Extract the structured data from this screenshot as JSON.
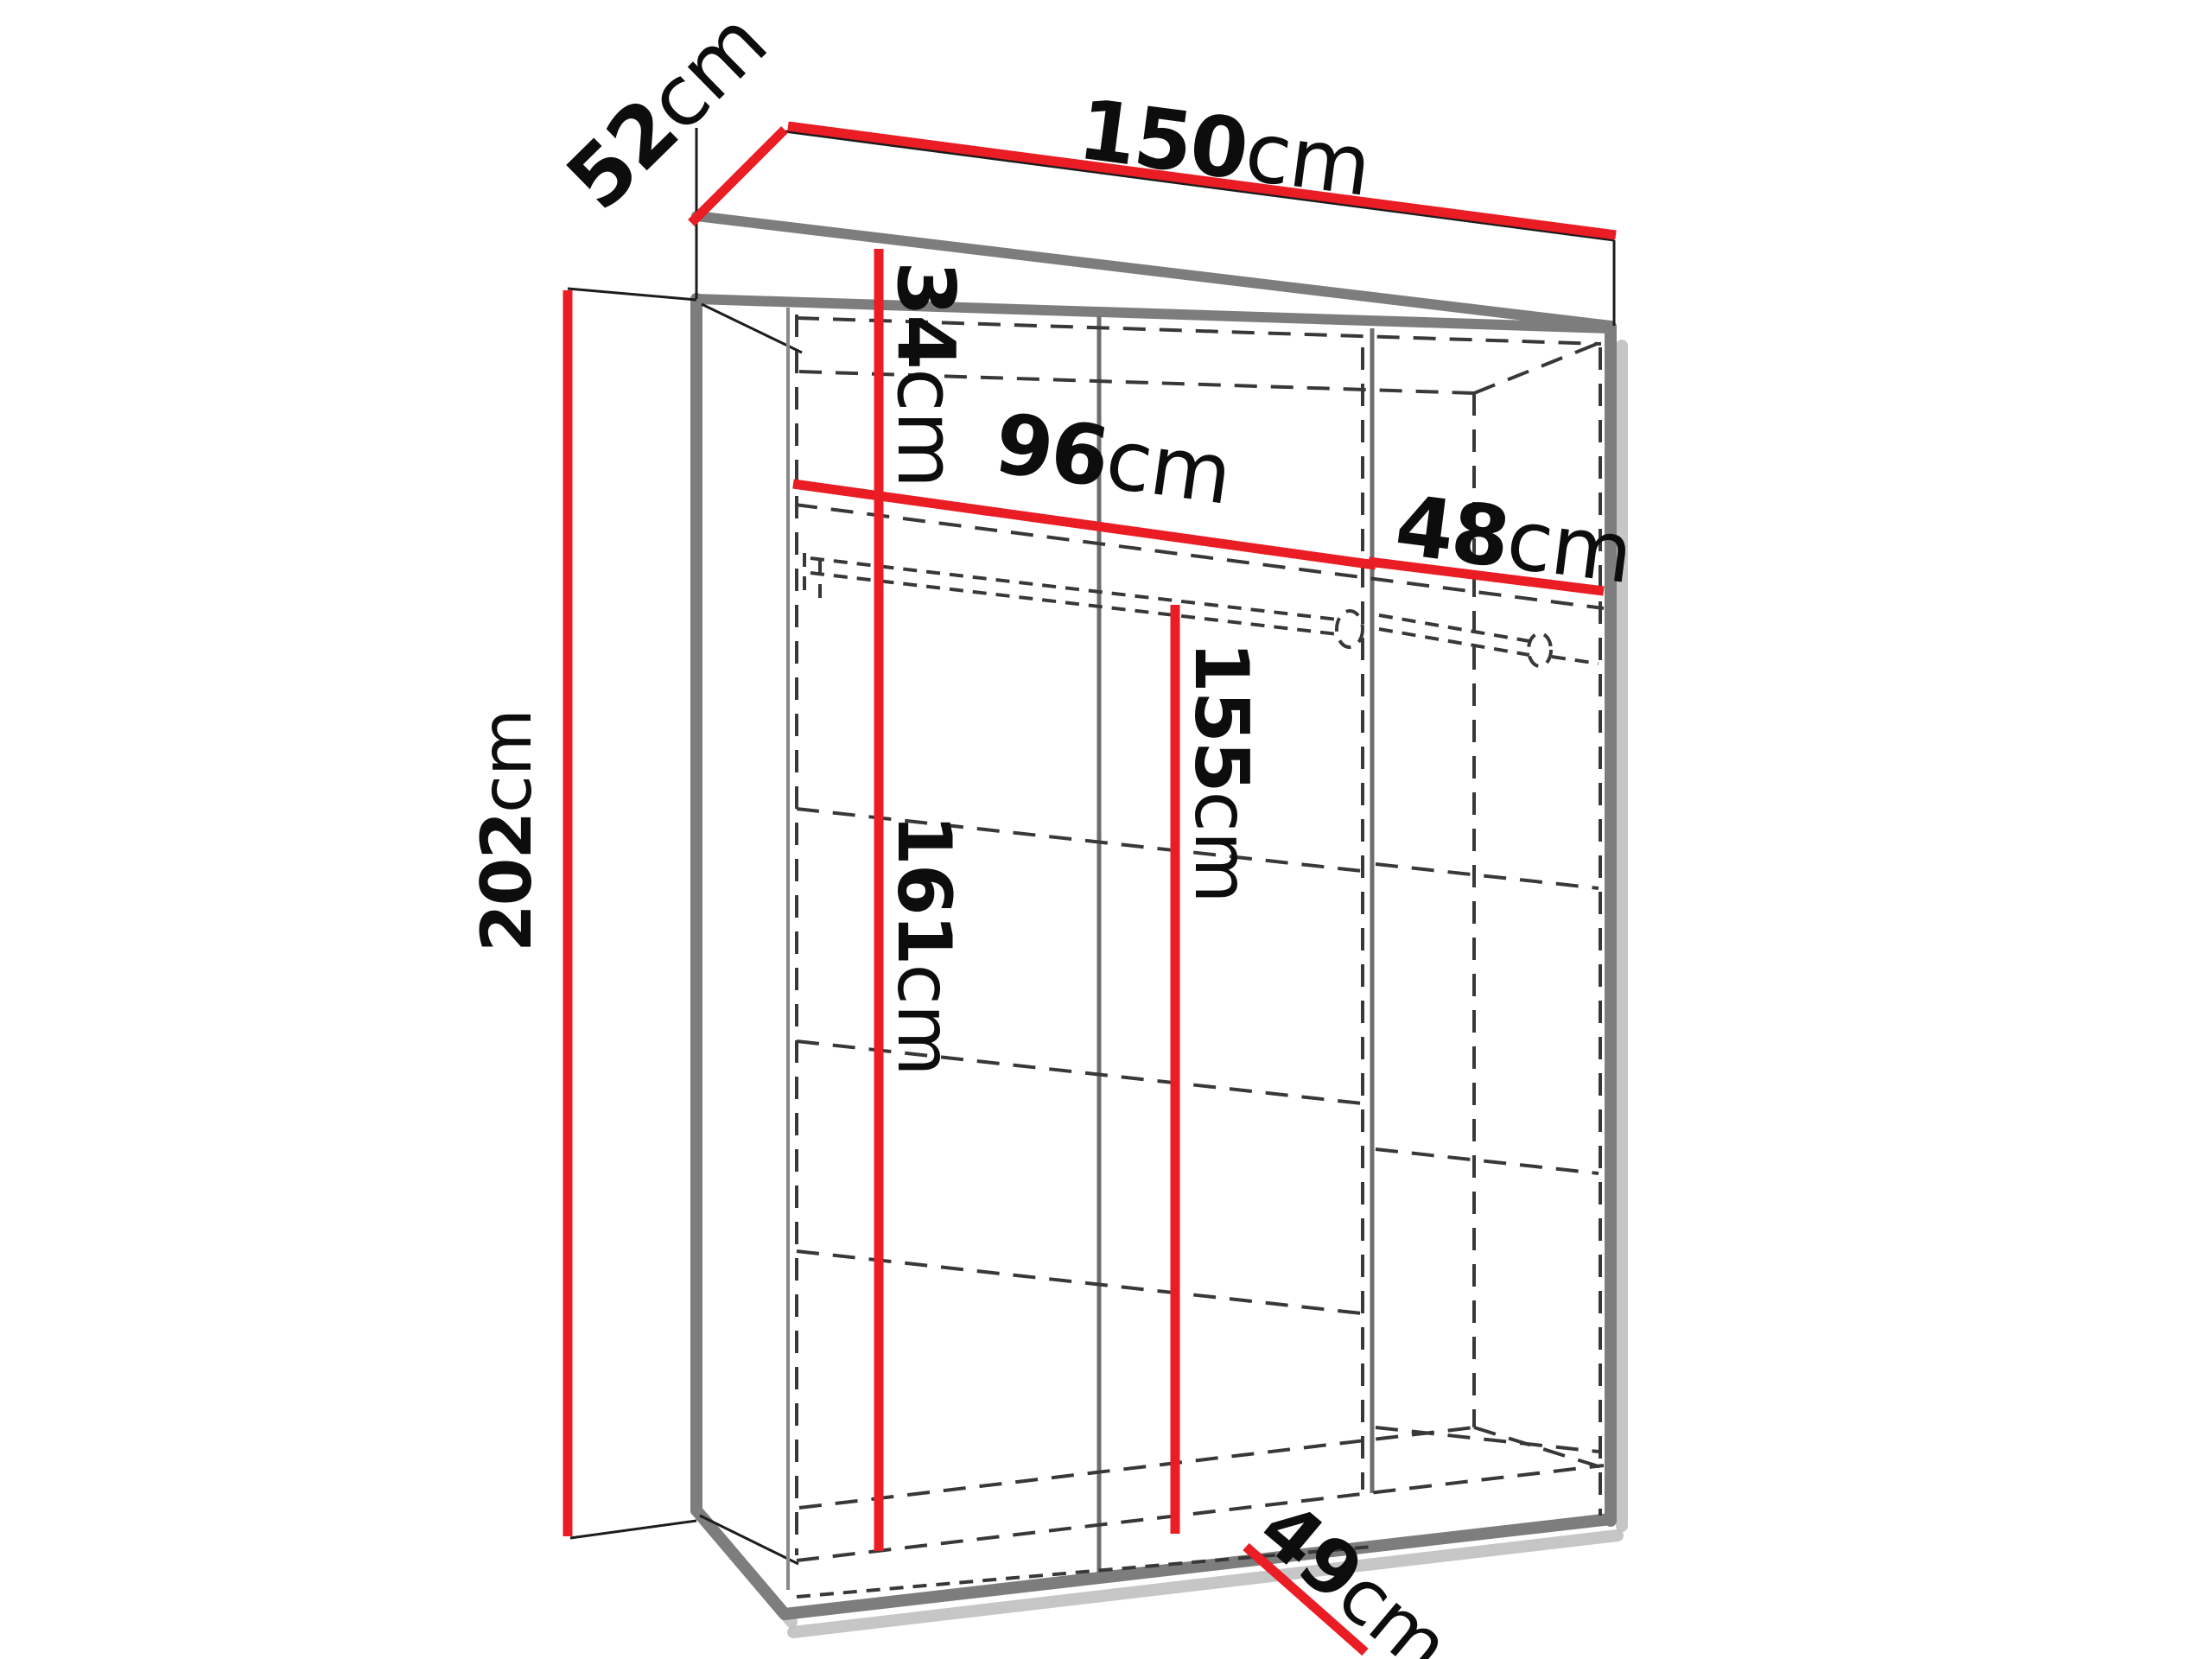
{
  "diagram": {
    "type": "furniture-dimension-diagram",
    "subject": "wardrobe interior dimensions, three-quarter perspective line drawing",
    "unit": "cm",
    "colors": {
      "dimension_line": "#ea1c24",
      "edge_gray": "#7d7d7d",
      "hidden_line_dash": "#383838",
      "text": "#0d0d0d",
      "background": "#ffffff"
    },
    "dimensions": {
      "top_width": {
        "value": "150",
        "unit": "cm",
        "meaning": "overall width along top back edge"
      },
      "top_depth": {
        "value": "52",
        "unit": "cm",
        "meaning": "overall depth along top left edge"
      },
      "height": {
        "value": "202",
        "unit": "cm",
        "meaning": "overall height, left side"
      },
      "upper_shelf_height": {
        "value": "34",
        "unit": "cm",
        "meaning": "height of top shelf compartment"
      },
      "left_section_width": {
        "value": "96",
        "unit": "cm",
        "meaning": "interior width of left section at shelf"
      },
      "right_section_width": {
        "value": "48",
        "unit": "cm",
        "meaning": "interior width of right section at shelf"
      },
      "left_interior_height": {
        "value": "161",
        "unit": "cm",
        "meaning": "interior height below shelf, left section"
      },
      "center_interior_height": {
        "value": "155",
        "unit": "cm",
        "meaning": "interior height below hanging rod, center"
      },
      "bottom_depth": {
        "value": "49",
        "unit": "cm",
        "meaning": "interior depth at bottom"
      }
    },
    "features": [
      "top shelf",
      "two hanging rods",
      "side shelves",
      "center partition",
      "open front"
    ]
  }
}
